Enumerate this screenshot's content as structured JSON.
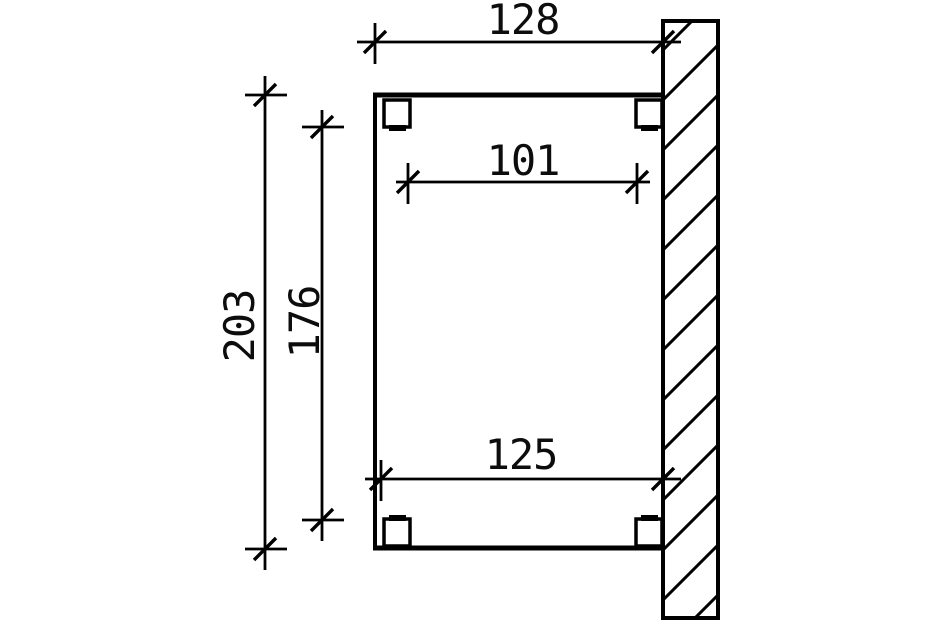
{
  "dims": {
    "overall_width": "128",
    "inner_width": "101",
    "overall_height": "203",
    "inner_height": "176",
    "bottom_width": "125"
  },
  "style": {
    "line_color": "#000000",
    "background": "#ffffff"
  }
}
